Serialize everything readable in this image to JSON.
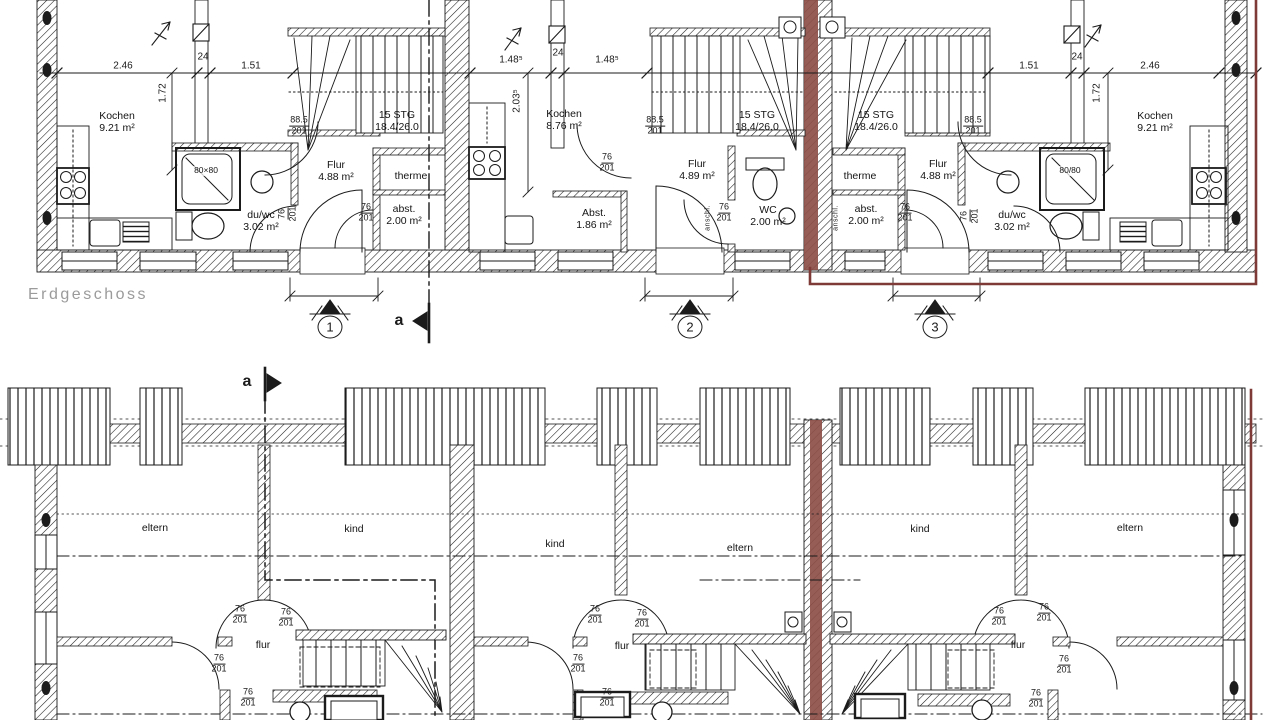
{
  "floor_title": "Erdgeschoss",
  "colors": {
    "ink": "#1b1b1b",
    "highlight_red": "#7d3a36",
    "wall_red": "#8d4f48",
    "title_gray": "#9b9b9b",
    "paper": "#ffffff"
  },
  "upper": {
    "rooms": [
      {
        "t": "Kochen\n9.21 m²"
      },
      {
        "t": "du/wc\n3.02 m²"
      },
      {
        "t": "Flur\n4.88 m²"
      },
      {
        "t": "15 STG\n18.4/26.0"
      },
      {
        "t": "therme"
      },
      {
        "t": "abst.\n2.00 m²"
      },
      {
        "t": "Kochen\n8.76 m²"
      },
      {
        "t": "Abst.\n1.86 m²"
      },
      {
        "t": "Flur\n4.89 m²"
      },
      {
        "t": "WC\n2.00 m²"
      },
      {
        "t": "15 STG\n18.4/26.0"
      },
      {
        "t": "15 STG\n18.4/26.0"
      },
      {
        "t": "therme"
      },
      {
        "t": "abst.\n2.00 m²"
      },
      {
        "t": "Flur\n4.88 m²"
      },
      {
        "t": "du/wc\n3.02 m²"
      },
      {
        "t": "Kochen\n9.21 m²"
      },
      {
        "t": "80×80"
      },
      {
        "t": "80/80"
      }
    ],
    "dims": [
      {
        "t": "2.46"
      },
      {
        "t": "24"
      },
      {
        "t": "1.51"
      },
      {
        "t": "1.48⁵"
      },
      {
        "t": "24"
      },
      {
        "t": "1.48⁵"
      },
      {
        "t": "1.51"
      },
      {
        "t": "24"
      },
      {
        "t": "2.46"
      },
      {
        "t": "1.72"
      },
      {
        "t": "2.03⁵"
      },
      {
        "t": "1.72"
      }
    ],
    "fracs": [
      {
        "top": "88.5",
        "bot": "201"
      },
      {
        "top": "76",
        "bot": "201"
      },
      {
        "top": "88.5",
        "bot": "201"
      },
      {
        "top": "76",
        "bot": "201"
      },
      {
        "top": "76",
        "bot": "201"
      },
      {
        "top": "88.5",
        "bot": "201"
      },
      {
        "top": "76",
        "bot": "201"
      },
      {
        "top": "76",
        "bot": "201"
      },
      {
        "top": "76",
        "bot": "201"
      }
    ],
    "rotated_notes": [
      {
        "t": "anschl."
      },
      {
        "t": "anschl."
      }
    ],
    "entrance_markers": [
      {
        "n": "1"
      },
      {
        "n": "2"
      },
      {
        "n": "3"
      }
    ],
    "section_label": "a"
  },
  "lower": {
    "rooms": [
      {
        "t": "eltern"
      },
      {
        "t": "kind"
      },
      {
        "t": "kind"
      },
      {
        "t": "eltern"
      },
      {
        "t": "kind"
      },
      {
        "t": "eltern"
      },
      {
        "t": "flur"
      },
      {
        "t": "flur"
      },
      {
        "t": "flur"
      }
    ],
    "fracs": [
      {
        "top": "76",
        "bot": "201"
      },
      {
        "top": "76",
        "bot": "201"
      },
      {
        "top": "76",
        "bot": "201"
      },
      {
        "top": "76",
        "bot": "201"
      },
      {
        "top": "76",
        "bot": "201"
      },
      {
        "top": "76",
        "bot": "201"
      },
      {
        "top": "76",
        "bot": "201"
      },
      {
        "top": "76",
        "bot": "201"
      },
      {
        "top": "76",
        "bot": "201"
      },
      {
        "top": "76",
        "bot": "201"
      },
      {
        "top": "76",
        "bot": "201"
      },
      {
        "top": "76",
        "bot": "201"
      }
    ],
    "section_label": "a"
  }
}
